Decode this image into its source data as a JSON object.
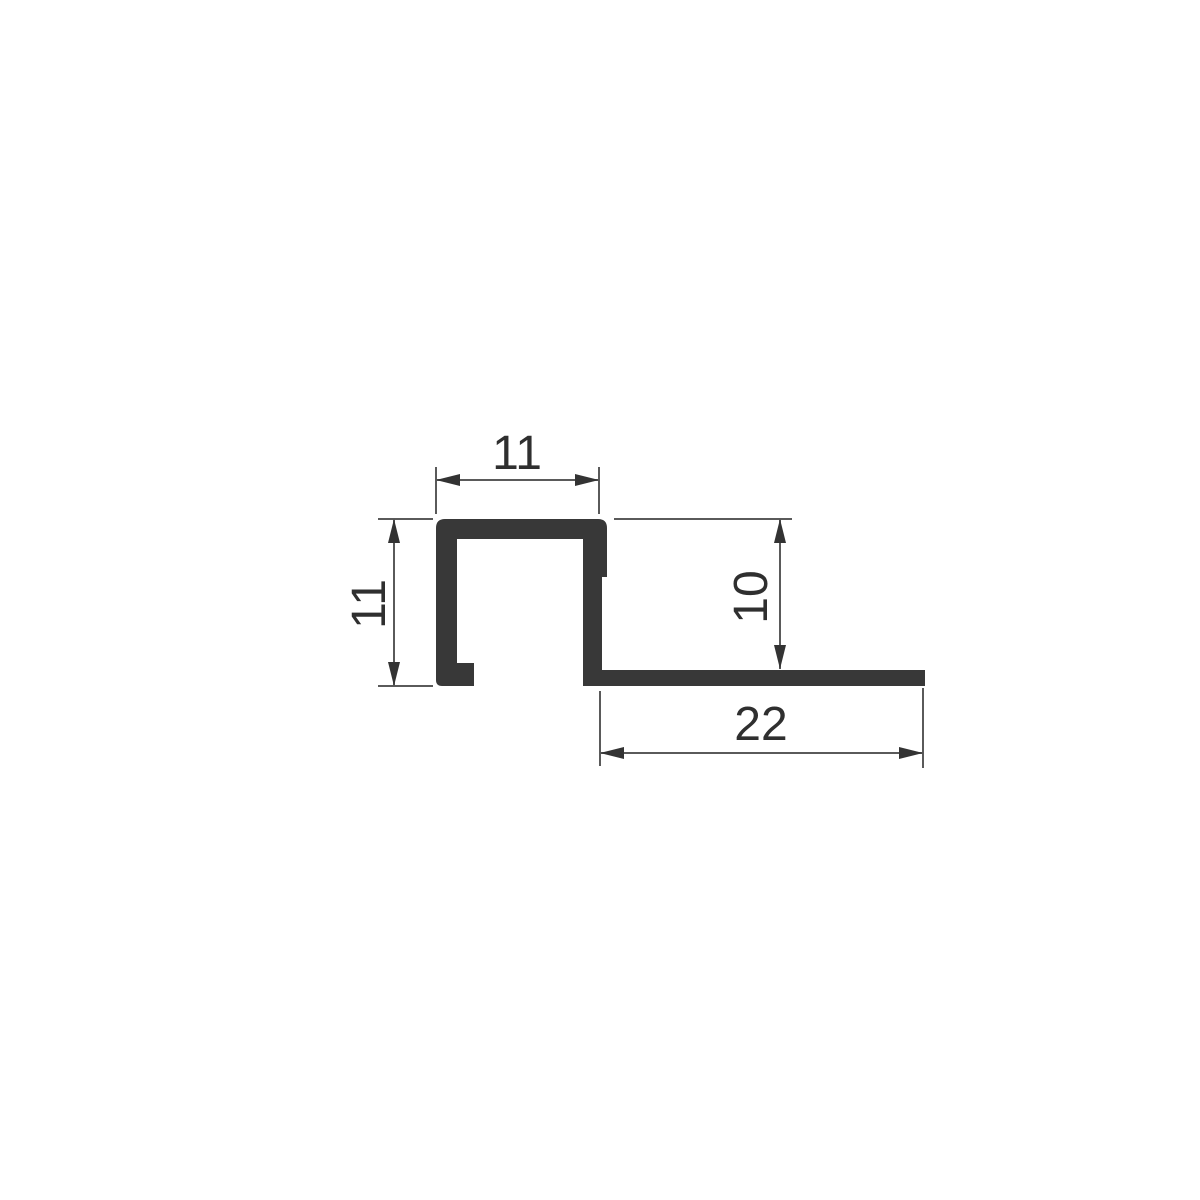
{
  "drawing": {
    "kind": "profile-cross-section-technical-drawing",
    "dimensions": {
      "top_width": {
        "value": "11"
      },
      "left_height": {
        "value": "11"
      },
      "right_depth": {
        "value": "10"
      },
      "bottom_length": {
        "value": "22"
      }
    }
  },
  "colors": {
    "background": "#ffffff",
    "profile": "#383838",
    "line": "#5a5a5a",
    "arrow": "#333333",
    "text": "#2f2f2f"
  }
}
